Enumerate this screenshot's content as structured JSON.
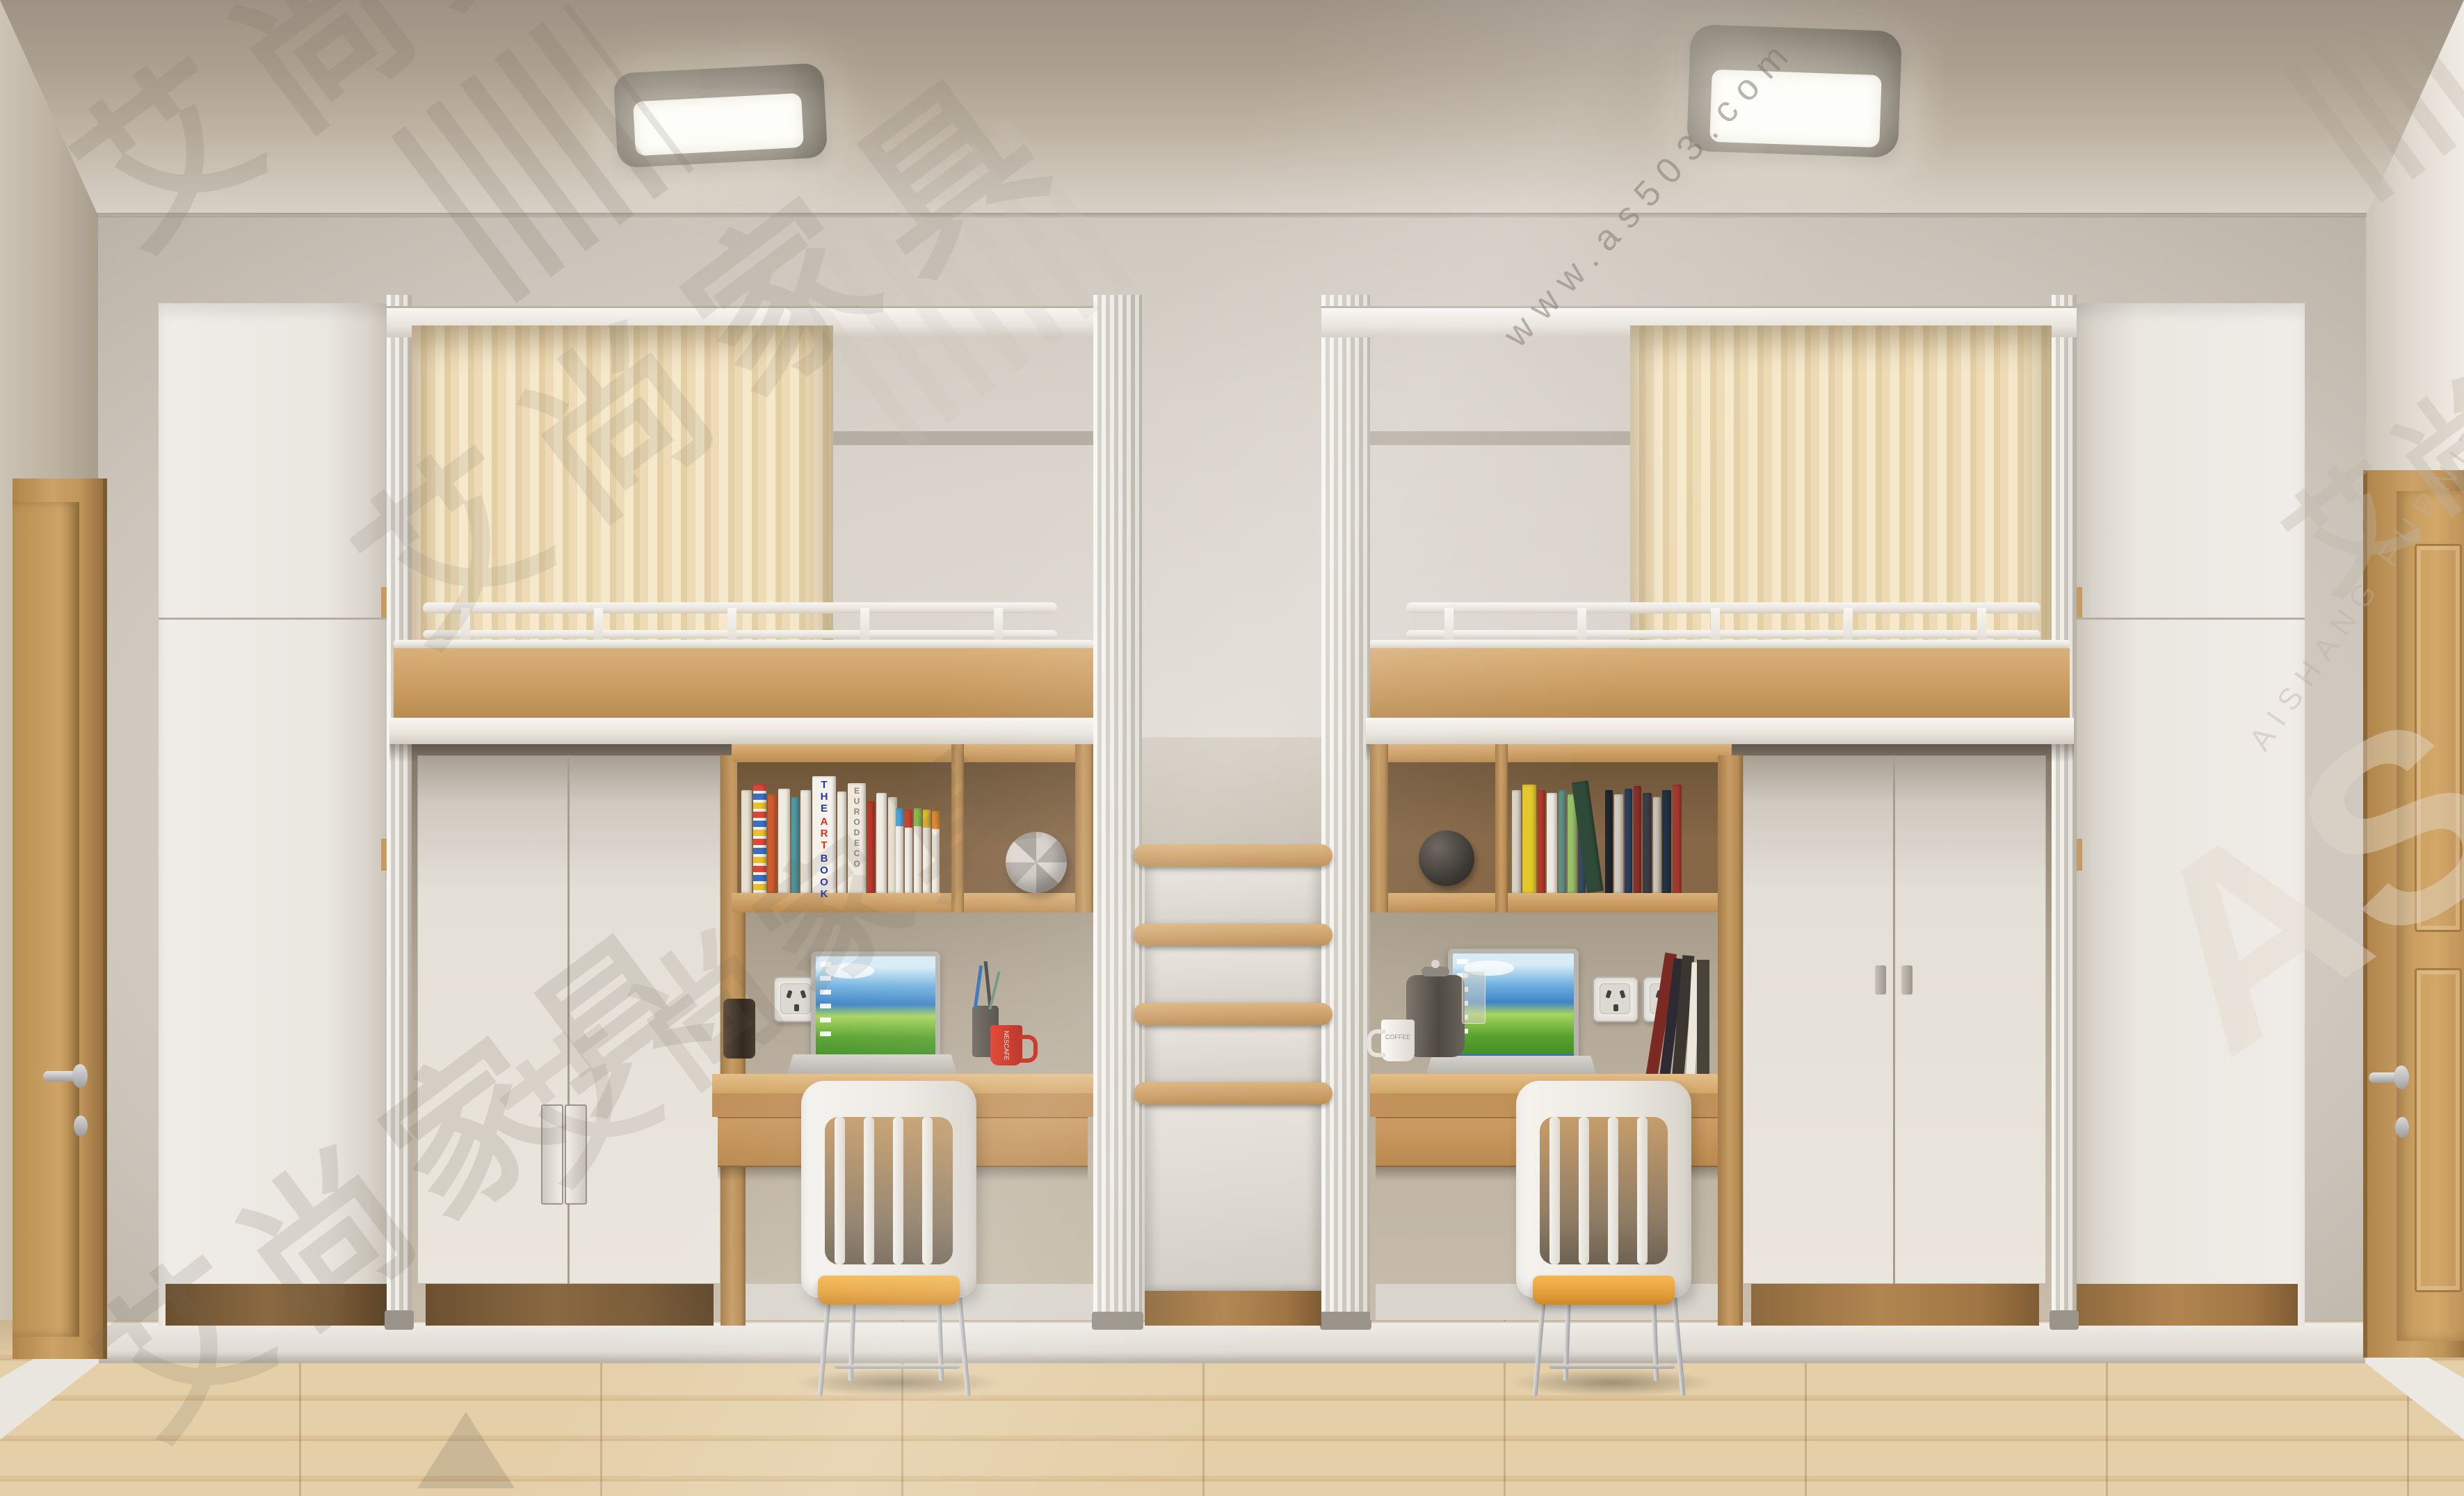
{
  "scene": {
    "description": "3D furniture showroom render: dormitory room with two white loft beds over desks and wardrobes, central drawer staircase, wooden doors on both sides, two ceiling lights",
    "colors": {
      "wall": "#d8d2c9",
      "ceiling": "#ab9f8f",
      "floor_wood": "#ddc59c",
      "furniture_white": "#eae6e0",
      "desk_wood": "#cb9d63",
      "curtain_cream": "#eedbb6",
      "seat_cushion_orange": "#e6a23c",
      "mug_red": "#d02a1d"
    }
  },
  "watermarks": {
    "brand": "艾尚家具",
    "url": "www.as503.com",
    "logo": "AS",
    "latin": "AISHANG FURNITURE"
  },
  "labels": {
    "book_the": "THE",
    "book_art": "ART",
    "book_book": "BOOK",
    "book_eurodeco": "EURODECO",
    "mug_left_text": "NESCAFE",
    "mug_right_text": "COFFEE"
  }
}
